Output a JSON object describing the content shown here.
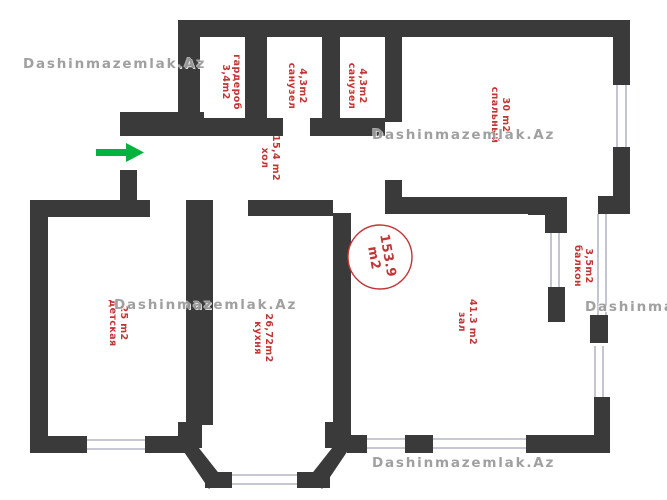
{
  "watermark": {
    "text": "Dashinmazemlak.Az"
  },
  "total_area_badge": {
    "area": "153.9",
    "unit": "m2"
  },
  "rooms": {
    "wardrobe": {
      "area": "3,4m2",
      "name": "гардероб"
    },
    "bathroom1": {
      "area": "4,3m2",
      "name": "санузел"
    },
    "bathroom2": {
      "area": "4,3m2",
      "name": "санузел"
    },
    "bedroom": {
      "area": "30 m2",
      "name": "спальный"
    },
    "hall": {
      "area": "15,4 m2",
      "name": "хол"
    },
    "nursery": {
      "area": "25 m2",
      "name": "детская"
    },
    "kitchen": {
      "area": "26,72m2",
      "name": "кухня"
    },
    "living_room": {
      "area": "41.3 m2",
      "name": "зал"
    },
    "balcony": {
      "area": "3,5m2",
      "name": "балкон"
    }
  },
  "colors": {
    "wall": "#3a3a3a",
    "label": "#c13535",
    "watermark": "#9b9b9b",
    "arrow": "#00b33c",
    "glass": "#b6b6c6",
    "circle": "#c13535",
    "background": "#ffffff"
  }
}
